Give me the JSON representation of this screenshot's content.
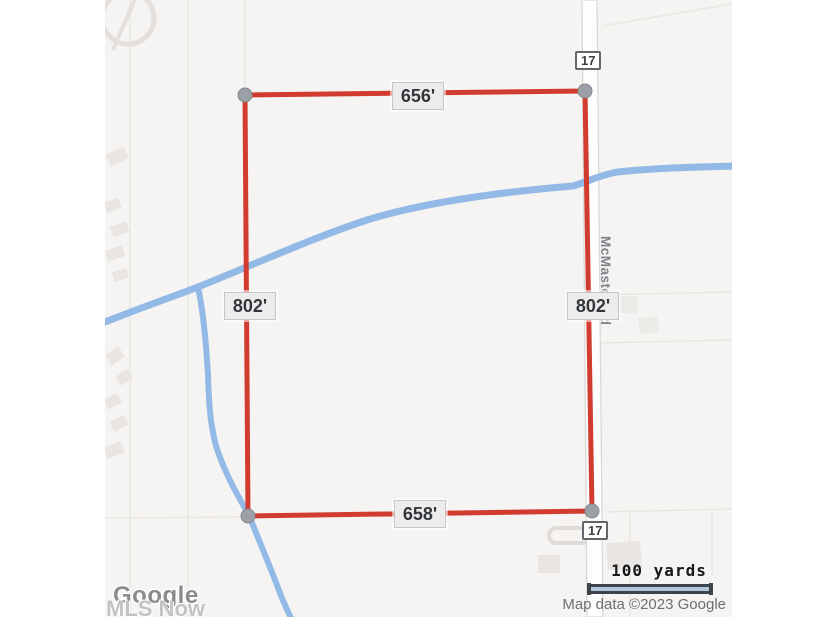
{
  "map": {
    "type": "parcel-boundary-map",
    "boundary": {
      "top_length": "656'",
      "left_length": "802'",
      "right_length": "802'",
      "bottom_length": "658'"
    },
    "road": {
      "name": "McMaster Rd",
      "route_shield_top": "17",
      "route_shield_bottom": "17"
    },
    "scale_bar": {
      "label": "100 yards"
    },
    "attribution": {
      "logo": "Google",
      "text": "Map data ©2023 Google"
    },
    "watermark": "MLS Now",
    "colors": {
      "boundary_red": "#d23b2f",
      "water_blue": "#93b9e7",
      "corner_dot_gray": "#9aa0a6",
      "map_background": "#f6f4f2",
      "road_fill": "#fdfdfd",
      "parcel_line": "#e9e6e2"
    }
  }
}
